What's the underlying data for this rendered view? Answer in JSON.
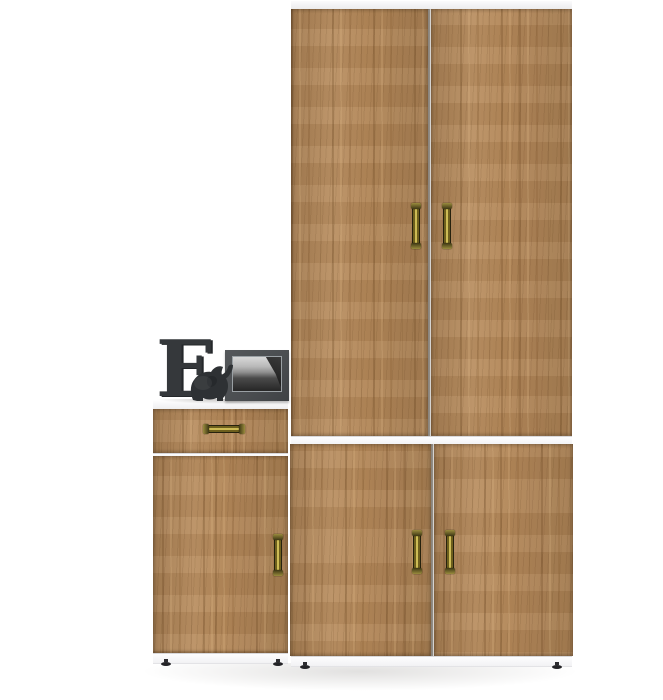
{
  "scene": {
    "type": "furniture-product-photo",
    "background_color": "#ffffff",
    "items": [
      "tall oak wardrobe with four doors",
      "oak hallway cabinet with one drawer and one door",
      "decorative block letter",
      "elephant figurine",
      "framed black-and-white coastal photo"
    ]
  },
  "palette": {
    "bg": "#ffffff",
    "wood_base": "#b5895a",
    "wood_dark": "#8a6336",
    "wood_light": "#cfa678",
    "carcass_white": "#f7f7f9",
    "edge_gray": "#d8d8db",
    "gap_line": "#8e887f",
    "brass_dark": "#4c431a",
    "brass_light": "#cdbc55",
    "brass_edge": "#26220e",
    "decor_dark": "#35383b",
    "photo_frame": "#4a4d50",
    "foot_black": "#232327"
  },
  "decor": {
    "letter_text": "E"
  },
  "counts": {
    "wardrobe_doors": 4,
    "cabinet_drawers": 1,
    "cabinet_doors": 1,
    "brass_handles": 6,
    "visible_feet": 4
  }
}
